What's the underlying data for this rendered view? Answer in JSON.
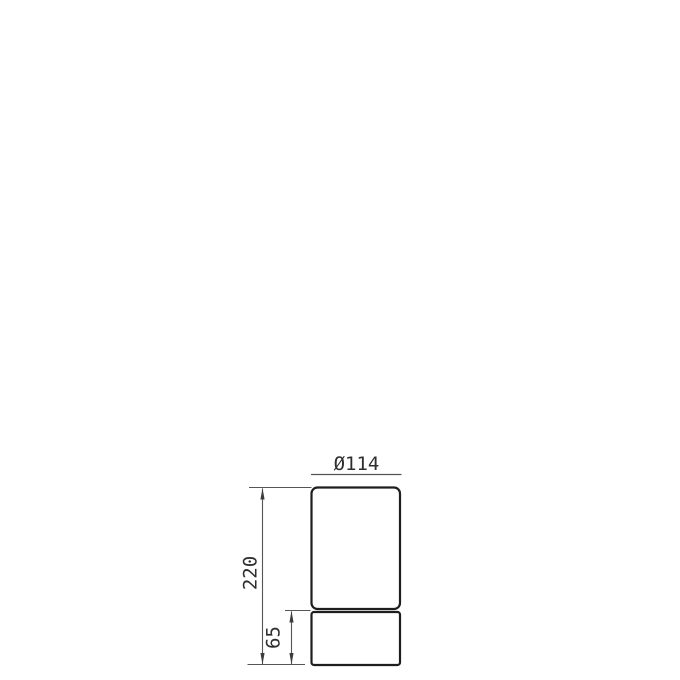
{
  "drawing": {
    "labels": {
      "diameter": "Ø114",
      "total_height": "220",
      "base_height": "65"
    },
    "colors": {
      "outline": "#1e1e1e",
      "dimension_line": "#555555",
      "arrow": "#3d3d3d",
      "text": "#2e2e2e",
      "background": "#ffffff"
    }
  }
}
